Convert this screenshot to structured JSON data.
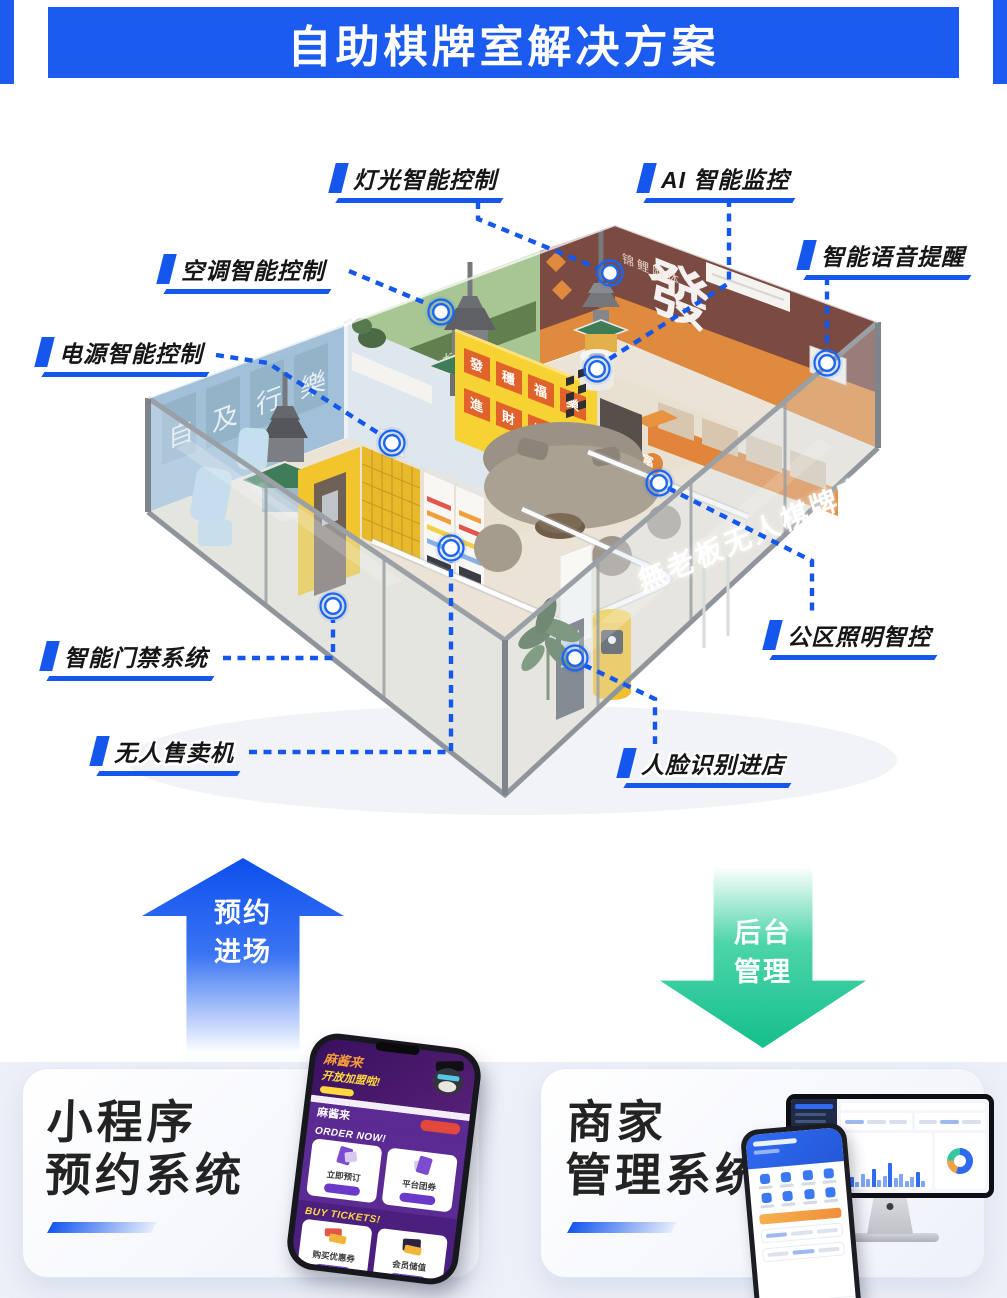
{
  "header": {
    "title": "自助棋牌室解决方案",
    "accent_color": "#1b5bf0"
  },
  "room": {
    "labels": [
      {
        "id": "light",
        "text": "灯光智能控制"
      },
      {
        "id": "ai-monitor",
        "text": "AI 智能监控"
      },
      {
        "id": "voice",
        "text": "智能语音提醒"
      },
      {
        "id": "aircon",
        "text": "空调智能控制"
      },
      {
        "id": "power",
        "text": "电源智能控制"
      },
      {
        "id": "door-access",
        "text": "智能门禁系统"
      },
      {
        "id": "vending",
        "text": "无人售卖机"
      },
      {
        "id": "public-light",
        "text": "公区照明智控"
      },
      {
        "id": "face-entry",
        "text": "人脸识别进店"
      }
    ],
    "glass_sign": "無老板无人棋牌室",
    "wall_texts": {
      "green_band": "吃摸碰杠",
      "brown_small": "锦鲤附体",
      "graffiti": "發",
      "blue_posters": [
        "自",
        "及",
        "行",
        "樂"
      ],
      "posters_row1": [
        "發",
        "穩",
        "福",
        "樂"
      ],
      "posters_row2": [
        "進",
        "財",
        "順",
        "旺"
      ],
      "board_line1": "一夜暴富",
      "board_line2": "两夜也行"
    },
    "marker_color": "#1b66f0",
    "connector_color": "#1457ec"
  },
  "flow": {
    "reserve_arrow": {
      "line1": "预约",
      "line2": "进场",
      "color": "#1456ee"
    },
    "admin_arrow": {
      "line1": "后台",
      "line2": "管理",
      "color": "#1cc492"
    }
  },
  "sections": {
    "miniprogram": {
      "title_line1": "小程序",
      "title_line2": "预约系统"
    },
    "merchant": {
      "title_line1": "商家",
      "title_line2": "管理系统"
    }
  },
  "phone_app": {
    "hero_brand": "麻酱来",
    "hero_promo": "开放加盟啦!",
    "brand_row": "麻酱来",
    "order_header": "ORDER NOW!",
    "tickets_header": "BUY TICKETS!",
    "card1": "立即预订",
    "card2": "平台团券",
    "card3": "购买优惠券",
    "card4": "会员储值"
  }
}
